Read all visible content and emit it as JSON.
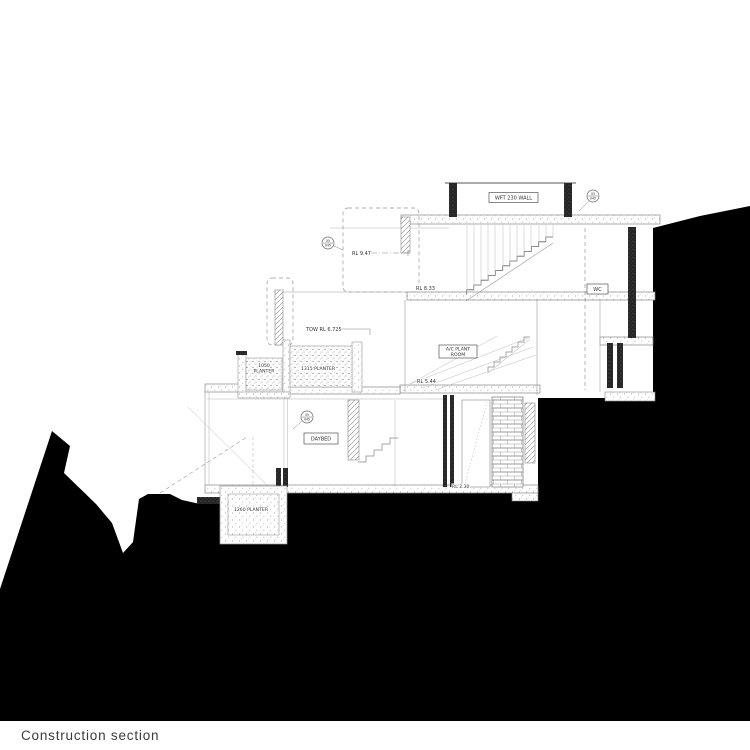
{
  "caption": "Construction section",
  "labels": {
    "wft_wall": "WFT 230 WALL",
    "rl_947": "RL 9.47",
    "rl_833": "RL 8.33",
    "tow_6725": "TOW RL 6.725",
    "rl_544": "RL 5.44",
    "rl_230": "RL 2.30",
    "planter_1315": "1315 PLANTER",
    "planter_1050_line1": "1050",
    "planter_1050_line2": "PLANTER",
    "planter_1260": "1260 PLANTER",
    "ac_plant_line1": "A/C PLANT",
    "ac_plant_line2": "ROOM",
    "daybed": "DAYBED",
    "wc": "WC",
    "marker_detail": "05",
    "marker_sheet": "045"
  },
  "colors": {
    "terrain": "#000000",
    "line_light": "#aaaaaa",
    "line_mid": "#888888",
    "line_dark": "#444444"
  }
}
